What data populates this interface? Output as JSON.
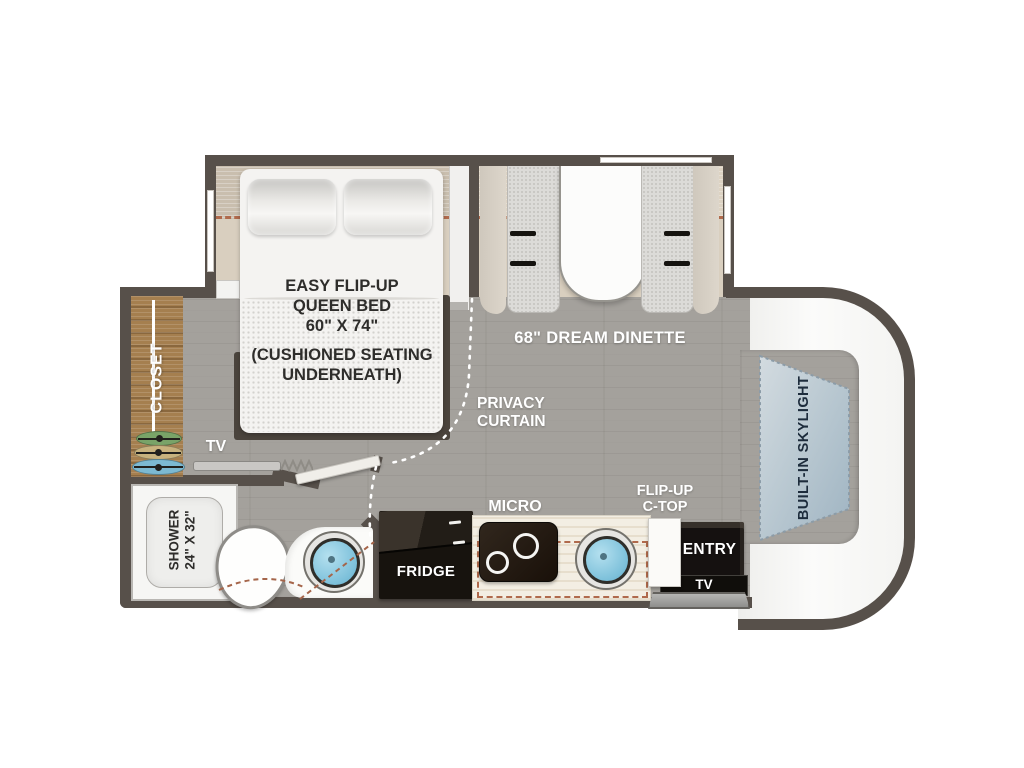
{
  "title": "RV Floor Plan",
  "colors": {
    "wall": "#57504a",
    "floor": "#a4a19c",
    "slide_floor": "#d9cfbf",
    "slide_dash_line": "#b06a4c",
    "closet_wood": "#a57f4f",
    "skylight_fill_light": "#cfd8dd",
    "skylight_fill_dark": "#a2b6c3",
    "appliance_black": "#17130e",
    "sink_blue": "#7cc0da",
    "hanger_green": "#79a368",
    "hanger_tan": "#c8b27e",
    "hanger_blue": "#7cb9d2",
    "label_white": "#ffffff",
    "label_dark": "#2e2d2b",
    "skylight_text": "#1d2c3c"
  },
  "labels": {
    "bed": {
      "l1": "EASY FLIP-UP",
      "l2": "QUEEN BED",
      "l3": "60\" X 74\"",
      "l4": "(CUSHIONED SEATING",
      "l5": "UNDERNEATH)"
    },
    "dinette": "68\" DREAM DINETTE",
    "closet": "CLOSET",
    "privacy": {
      "l1": "PRIVACY",
      "l2": "CURTAIN"
    },
    "tv_bedroom": "TV",
    "shower": {
      "l1": "SHOWER",
      "l2": "24\" X 32\""
    },
    "micro": "MICRO",
    "fridge": "FRIDGE",
    "flip_up": {
      "l1": "FLIP-UP",
      "l2": "C-TOP"
    },
    "entry": "ENTRY",
    "tv_entry": "TV",
    "skylight": "BUILT-IN SKYLIGHT"
  }
}
